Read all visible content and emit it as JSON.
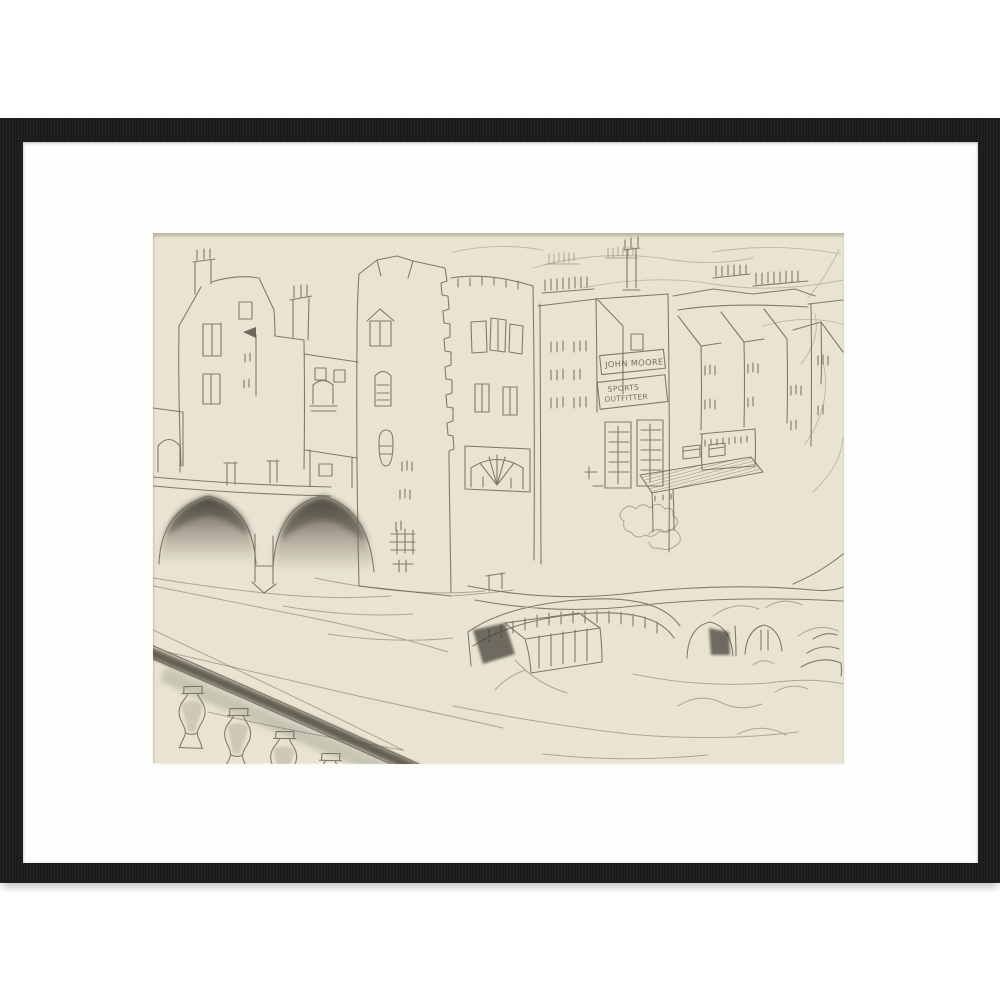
{
  "page": {
    "background": "#ffffff"
  },
  "artwork": {
    "kind": "framed pencil sketch of riverside buildings, bridge arches and balustrade",
    "frame_color": "#1a1a1a",
    "mat_color": "#fdfdfc",
    "paper_color": "#e9e4d2",
    "pencil_color": "#6d675a",
    "signs": {
      "shop_name": "JOHN MOORE",
      "shop_type_line1": "SPORTS",
      "shop_type_line2": "OUTFITTER"
    }
  }
}
